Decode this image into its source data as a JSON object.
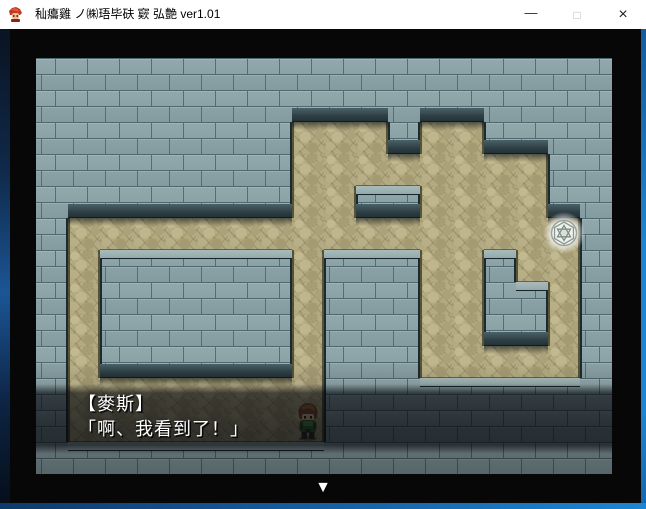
{
  "window": {
    "title": "秈癟雞 ノ㈱珸毕砆  窽  弘艶 ver1.01",
    "controls": {
      "minimize": "—",
      "maximize": "□",
      "close": "×"
    }
  },
  "game": {
    "dialog": {
      "name_line": "【麥斯】",
      "text_line": "「啊、我看到了！」"
    },
    "continue_indicator": "▼",
    "map": {
      "tile_size": 32,
      "origin": {
        "x": 36,
        "y": 58
      },
      "legend": {
        "W": "wall-brick",
        "P": "path-cobblestone"
      },
      "rows": [
        "WWWWWWWWWWWWWWWWWW",
        "WWWWWWWWWWWWWWWWWW",
        "WWWWWWWWPPPWPPWWWW",
        "WWWWWWWWPPPPPPPPWW",
        "WWWWWWWWPPWWPPPPWW",
        "WPPPPPPPPPPPPPPPPW",
        "WPWWWWWWPWWWPPWPPW",
        "WPWWWWWWPWWWPPWWPW",
        "WPWWWWWWPWWWPPWWPW",
        "WPWWWWWWPWWWPPPPPW",
        "WPPPPPPPPWWWWWWWWW",
        "WPPPPPPPPWWWWWWWWW",
        "WWWWWWWWWWWWWWWWWW"
      ],
      "gem": {
        "col": 16,
        "row": 5
      },
      "player": {
        "col": 8,
        "row": 11
      }
    },
    "colors": {
      "wall": "#8BA3A8",
      "wall_seam": "#526D73",
      "path": "#B3AA81",
      "ledge": "#2E4046",
      "dialog_dim": "rgba(4,6,12,0.60)",
      "border_blue": "#1B86D4"
    }
  }
}
